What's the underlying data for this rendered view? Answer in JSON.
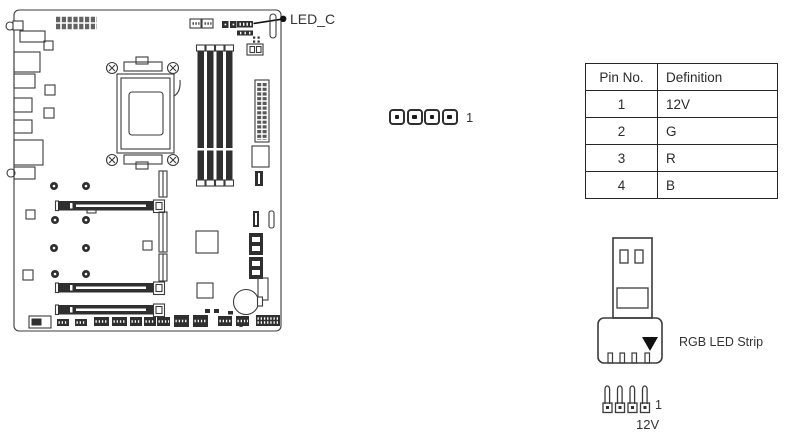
{
  "figure": {
    "title_callout": "LED_C",
    "middle_header": {
      "pin1": "1"
    },
    "table": {
      "columns": [
        "Pin No.",
        "Definition"
      ],
      "rows": [
        {
          "pin": "1",
          "definition": "12V"
        },
        {
          "pin": "2",
          "definition": "G"
        },
        {
          "pin": "3",
          "definition": "R"
        },
        {
          "pin": "4",
          "definition": "B"
        }
      ]
    },
    "strip": {
      "label": "RGB LED Strip",
      "pin1": "1",
      "voltage": "12V"
    },
    "colors": {
      "ink": "#3b3b3b",
      "dark_fill": "#2f2f2f",
      "text": "#333333"
    }
  }
}
